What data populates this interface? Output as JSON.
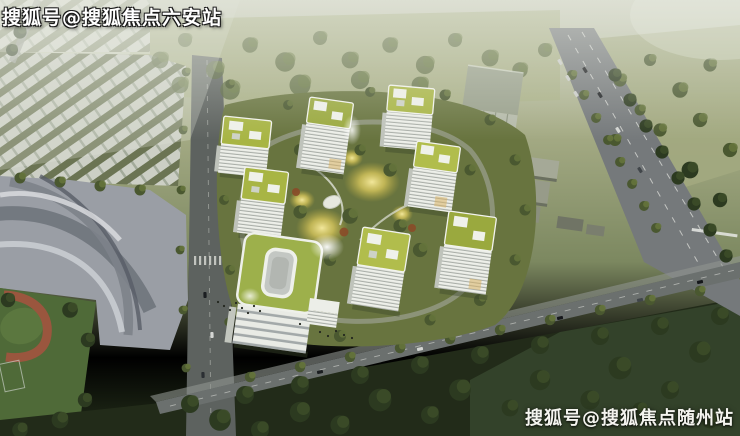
{
  "subject": "aerial architectural rendering of a residential complex with green-roofed towers",
  "watermarks": {
    "top_left": {
      "text": "搜狐号@搜狐焦点六安站"
    },
    "bottom_right": {
      "text": "搜狐号@搜狐焦点随州站"
    }
  },
  "palette": {
    "haze": "#cdd1c2",
    "field_top": "#a6ac84",
    "tree_olive": "#4a5830",
    "tree_dark": "#2c3a20",
    "tower_facade": "#edefe9",
    "tower_roof_green": "#a8b544",
    "school_roof_green": "#9db04b",
    "courtyard_ground": "#68743f",
    "night_glow_yellow": "#eeda6b",
    "plaza_gray": "#9a9ea5",
    "road_gray": "#75797b",
    "dark_band": "#222b19",
    "track_red": "#9a563e",
    "watermark": "#ffffff"
  }
}
